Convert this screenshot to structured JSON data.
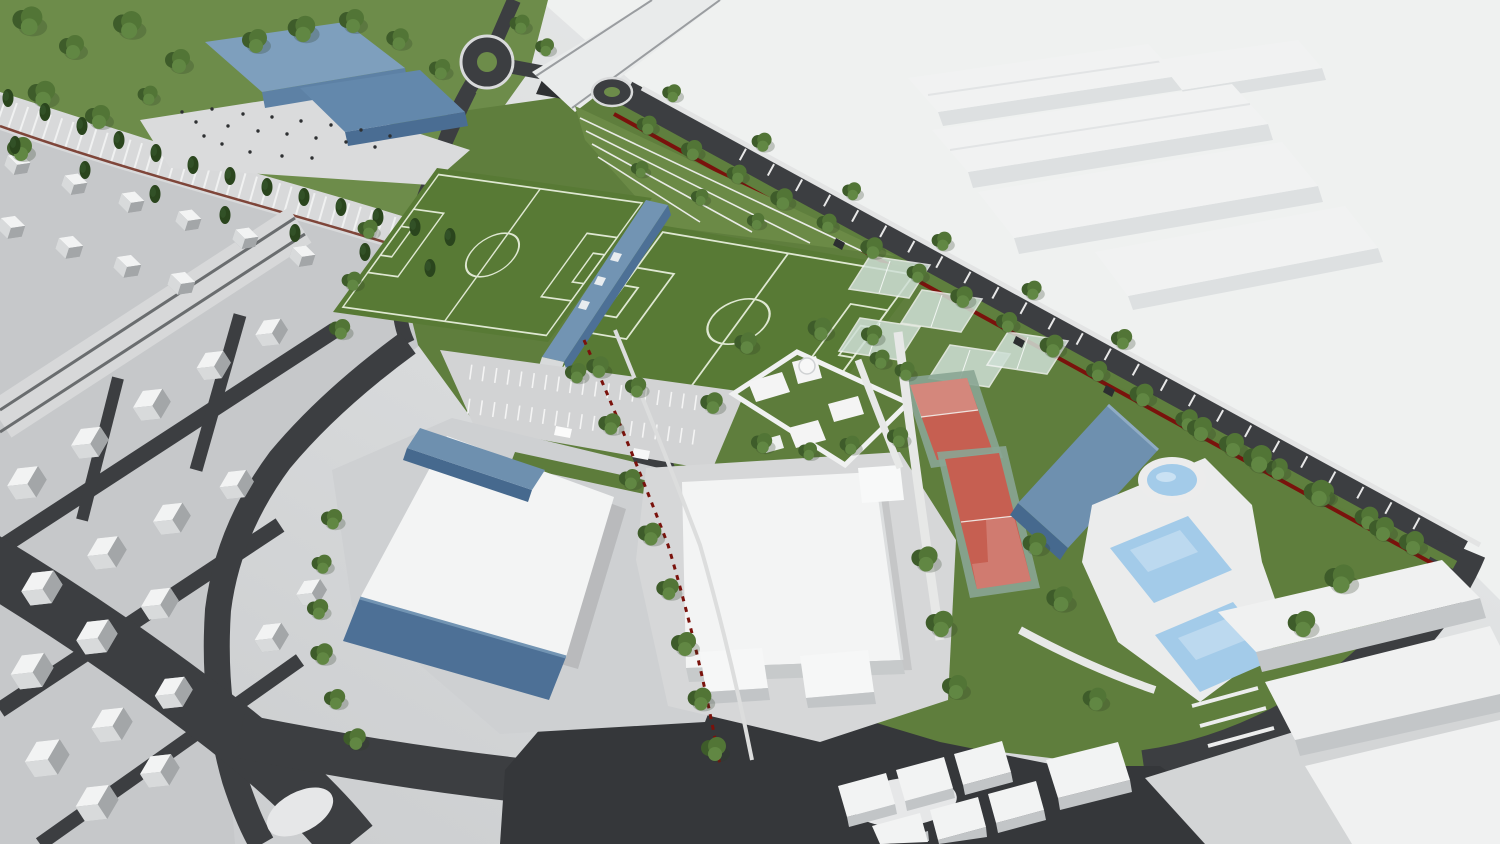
{
  "meta": {
    "title": "Aerial 3D rendering of a sports complex masterplan",
    "render_style": "3D architectural visualization, bird's-eye perspective view"
  },
  "palette": {
    "road": "#3c3e41",
    "junction": "#35373a",
    "park_grass": "#6d8c4a",
    "campus_grass": "#5f7e3d",
    "residential_ground": "#c6c8ca",
    "plaza": "#dadbdc",
    "parking": "#d2d3d4",
    "white_roof": "#f3f4f4",
    "building_side": "#c9cccd",
    "blue_roof": "#7e9fbd",
    "blue_wall": "#4d7096",
    "deck": "#ebecec",
    "vacant": "#eff1f0",
    "viaduct": "#e9ebeb",
    "tree_dark": "#3e5c2a",
    "tree_mid": "#527536",
    "tree_light": "#618743",
    "cypress": "#2a451d"
  },
  "scene": {
    "park": {
      "label": "Landscaped park with mature trees"
    },
    "civic_building": {
      "label": "Blue civic building with stepped volumes",
      "color": "#7e9fbd"
    },
    "plaza": {
      "label": "Public plaza with pedestrians",
      "people_count": 20
    },
    "stair_promenade": {
      "label": "Terraced stair promenade lined with cypress trees"
    },
    "residential": {
      "label": "Low-rise residential neighborhood (white massing)",
      "approx_house_count": 28
    },
    "avenue": {
      "label": "Divided avenue through the neighborhood"
    },
    "soccer_fields": {
      "label": "Twin soccer fields with white markings",
      "count": 2,
      "color": "#587a35",
      "line_color": "#dfe8d2"
    },
    "pavilion": {
      "label": "Linear changing-room pavilion between the fields",
      "color": "#7294b3"
    },
    "terraces": {
      "label": "Grass spectator terraces beside the fields"
    },
    "parking": {
      "label": "Striped surface parking lot"
    },
    "sports_hall": {
      "label": "Large sports hall with white roof and blue facade",
      "facade_color": "#4d7096"
    },
    "event_building": {
      "label": "Large white event building"
    },
    "walled_compound": {
      "label": "Walled compound with domed building and gardens"
    },
    "padel_courts": {
      "label": "Glass-walled padel courts",
      "count": 5,
      "glass_color": "#cfe0d6"
    },
    "tennis_courts": {
      "label": "Fenced red tennis courts",
      "count": 2,
      "surface_color": "#c65f51",
      "fence_color": "#8aa593"
    },
    "gym_building": {
      "label": "Blue gymnasium beside the courts",
      "color": "#6e90af"
    },
    "pool_area": {
      "label": "Outdoor pool area with one round and two rectangular pools",
      "round_pool_count": 1,
      "rect_pool_count": 2,
      "water_color": "#a3cbe9"
    },
    "boulevard": {
      "label": "Tree-lined boulevard with bay parking and red boundary wall",
      "wall_color": "#7a120c"
    },
    "roundabouts": {
      "label": "Roundabouts with green islands",
      "count": 2
    },
    "viaduct": {
      "label": "Elevated walkway crossing the access road"
    },
    "warehouses": {
      "label": "Industrial warehouse buildings (context)",
      "count": 5
    },
    "vacant_land": {
      "label": "Vacant light-toned land"
    },
    "context_buildings": {
      "label": "Context buildings (white massing)"
    },
    "roads": {
      "label": "Asphalt road network"
    }
  }
}
